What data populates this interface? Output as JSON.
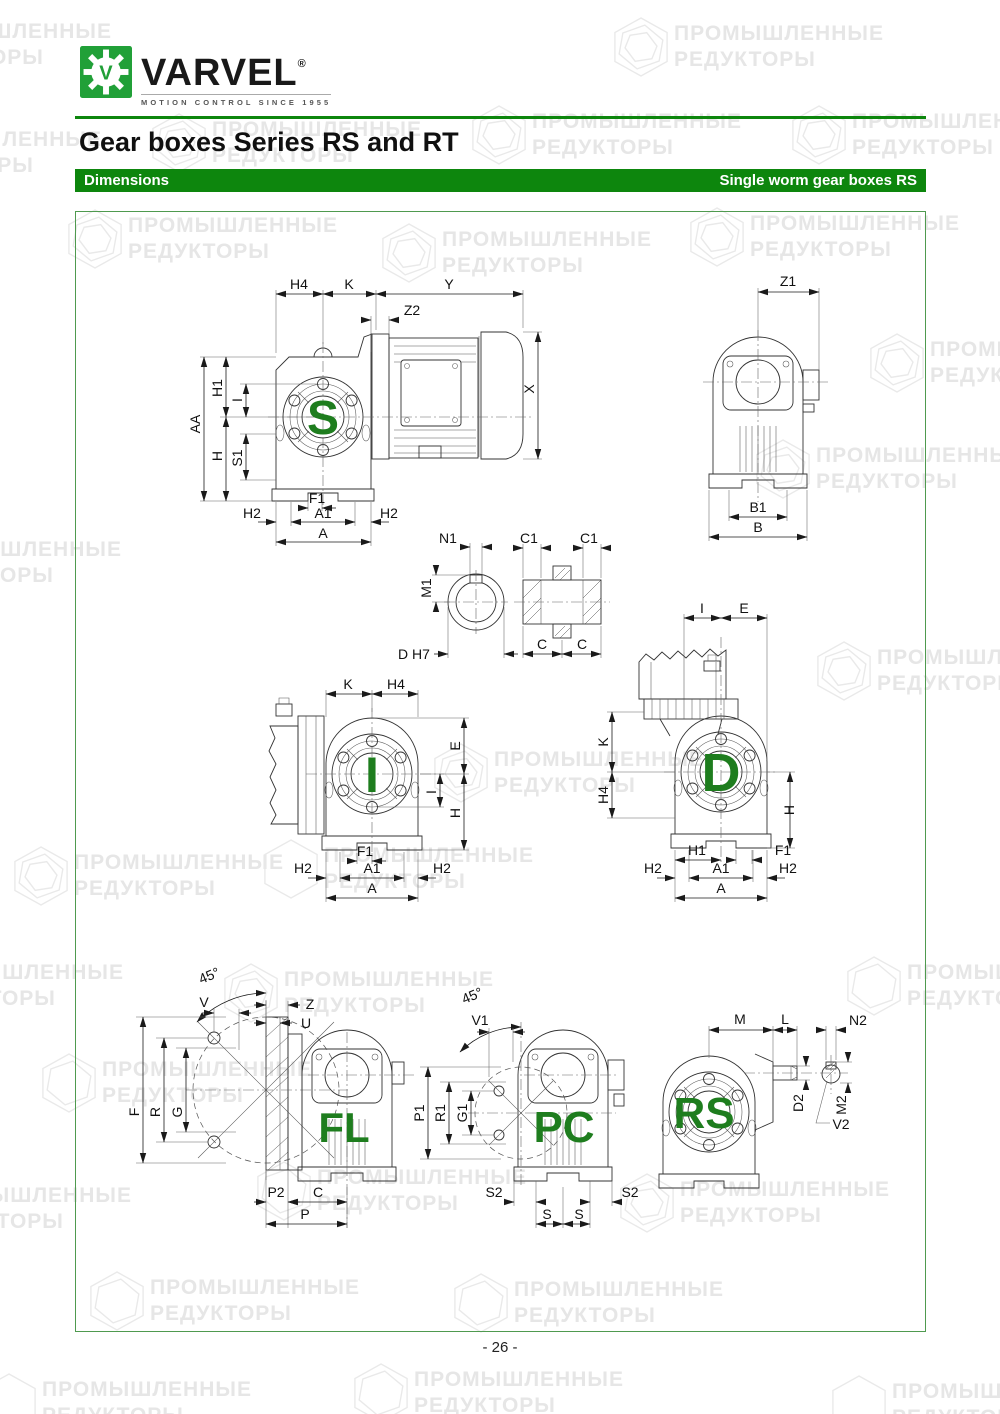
{
  "header": {
    "logo": {
      "brand": "VARVEL",
      "registered": "®",
      "tagline": "MOTION CONTROL SINCE 1955"
    },
    "title": "Gear boxes Series RS and RT",
    "bar_left": "Dimensions",
    "bar_right": "Single worm gear boxes RS"
  },
  "watermark": {
    "line1": "ПРОМЫШЛЕННЫЕ",
    "line2": "РЕДУКТОРЫ"
  },
  "footer": {
    "page_number": "- 26 -"
  },
  "colors": {
    "green_bar": "#0d860d",
    "logo_green": "#21a038",
    "letter_green": "#1e7d1e",
    "border_green": "#4f9a4f"
  },
  "figures": {
    "s": {
      "letter": "S",
      "dims": {
        "h4": "H4",
        "k": "K",
        "y": "Y",
        "z2": "Z2",
        "x": "X",
        "h1": "H1",
        "i": "I",
        "aa": "AA",
        "h": "H",
        "s1": "S1",
        "f1": "F1",
        "h2l": "H2",
        "a1": "A1",
        "h2r": "H2",
        "a": "A"
      }
    },
    "rear": {
      "dims": {
        "z1": "Z1",
        "b1": "B1",
        "b": "B"
      }
    },
    "shaft": {
      "dims": {
        "n1": "N1",
        "m1": "M1",
        "dh7": "D H7",
        "c1l": "C1",
        "c1r": "C1",
        "cl": "C",
        "cr": "C"
      }
    },
    "i": {
      "letter": "I",
      "dims": {
        "k": "K",
        "h4": "H4",
        "e": "E",
        "i": "I",
        "h": "H",
        "f1": "F1",
        "h2l": "H2",
        "a1": "A1",
        "h2r": "H2",
        "a": "A"
      }
    },
    "d": {
      "letter": "D",
      "dims": {
        "i": "I",
        "e": "E",
        "k": "K",
        "h4": "H4",
        "h": "H",
        "h1": "H1",
        "f1": "F1",
        "h2l": "H2",
        "a1": "A1",
        "h2r": "H2",
        "a": "A"
      }
    },
    "fl": {
      "letter": "FL",
      "dims": {
        "angle": "45°",
        "v": "V",
        "z": "Z",
        "u": "U",
        "f": "F",
        "r": "R",
        "g": "G",
        "p2": "P2",
        "c": "C",
        "p": "P"
      }
    },
    "pc": {
      "letter": "PC",
      "dims": {
        "angle": "45°",
        "v1": "V1",
        "p1": "P1",
        "r1": "R1",
        "g1": "G1",
        "s2l": "S2",
        "s2r": "S2",
        "sl": "S",
        "sr": "S"
      }
    },
    "rs": {
      "letter": "RS",
      "dims": {
        "m": "M",
        "l": "L",
        "n2": "N2",
        "d2": "D2",
        "m2": "M2",
        "v2": "V2"
      }
    }
  }
}
